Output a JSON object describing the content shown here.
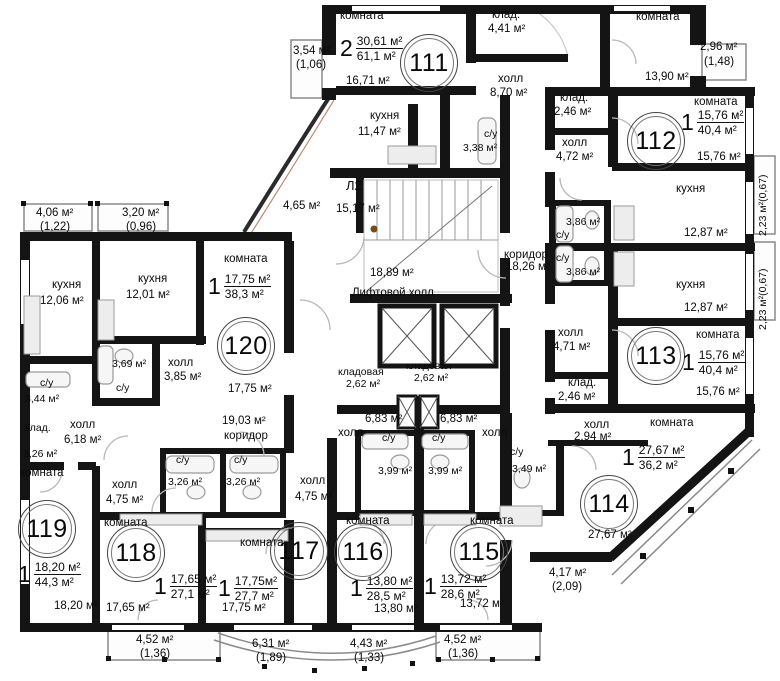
{
  "plan": {
    "common": {
      "stair": {
        "id": "Л2",
        "area": "15,17 м²"
      },
      "lift_hall": {
        "area": "18,89 м²",
        "label": "Лифтовой холл"
      },
      "vestibule_area": "4,65 м²",
      "corridor_right": {
        "label": "коридор",
        "area": "18,26 м²"
      },
      "corridor_left": {
        "area": "19,03 м²",
        "label": "коридор"
      },
      "storage_left": {
        "label": "кладовая",
        "area": "2,62 м²"
      },
      "storage_right": {
        "label": "кладовая",
        "area": "2,62 м²"
      }
    },
    "apartments": {
      "a111": {
        "number": "111",
        "rooms_count": "2",
        "area_living": "30,61 м²",
        "area_total": "61,1 м²",
        "room1_label": "комната",
        "room1_area": "16,71 м²",
        "room1_balcony": "3,54 м²",
        "room1_balcony_k": "(1,06)",
        "room2_label": "комната",
        "room2_area": "13,90 м²",
        "room2_balcony": "2,96 м²",
        "room2_balcony_k": "(1,48)",
        "storage_label": "клад.",
        "storage_area": "4,41 м²",
        "hall_label": "холл",
        "hall_area": "8,70 м²",
        "kitchen_label": "кухня",
        "kitchen_area": "11,47 м²",
        "wc_label": "с/у",
        "wc_area": "3,38 м²"
      },
      "a112": {
        "number": "112",
        "rooms_count": "1",
        "area_living": "15,76 м²",
        "area_total": "40,4 м²",
        "room_label": "комната",
        "room_area": "15,76 м²",
        "storage_label": "клад.",
        "storage_area": "2,46 м²",
        "hall_label": "холл",
        "hall_area": "4,72 м²",
        "kitchen_label": "кухня",
        "kitchen_area": "12,87 м²",
        "wc_label": "с/у",
        "wc_area": "3,86 м²",
        "balcony": "2,23 м²(0,67)"
      },
      "a113": {
        "number": "113",
        "rooms_count": "1",
        "area_living": "15,76 м²",
        "area_total": "40,4 м²",
        "room_label": "комната",
        "room_area": "15,76 м²",
        "storage_label": "клад.",
        "storage_area": "2,46 м²",
        "hall_label": "холл",
        "hall_area": "4,71 м²",
        "kitchen_label": "кухня",
        "kitchen_area": "12,87 м²",
        "wc_label": "с/у",
        "wc_area": "3,86 м²",
        "balcony": "2,23 м²(0,67)"
      },
      "a114": {
        "number": "114",
        "rooms_count": "1",
        "area_living": "27,67 м²",
        "area_total": "36,2 м²",
        "room_label": "комната",
        "room_area": "27,67 м²",
        "hall_label": "холл",
        "hall_area": "2,94 м²",
        "wc_label": "с/у",
        "wc_area": "3,49 м²",
        "balcony": "4,17 м²",
        "balcony_k": "(2,09)"
      },
      "a115": {
        "number": "115",
        "rooms_count": "1",
        "area_living": "13,72 м²",
        "area_total": "28,6 м²",
        "room_label": "комната",
        "room_area": "13,72 м²",
        "hall_label": "холл",
        "hall_area": "6,83 м²",
        "wc_label": "с/у",
        "wc_area": "3,99 м²",
        "balcony": "4,52 м²",
        "balcony_k": "(1,36)"
      },
      "a116": {
        "number": "116",
        "rooms_count": "1",
        "area_living": "13,80 м²",
        "area_total": "28,5 м²",
        "room_label": "комната",
        "room_area": "13,80 м²",
        "hall_label": "холл",
        "hall_area": "6,83 м²",
        "wc_label": "с/у",
        "wc_area": "3,99 м²",
        "balcony": "4,43 м²",
        "balcony_k": "(1,33)"
      },
      "a117": {
        "number": "117",
        "rooms_count": "1",
        "area_living": "17,75м²",
        "area_total": "27,7 м²",
        "room_label": "комната",
        "room_area": "17,75 м²",
        "hall_label": "холл",
        "hall_area": "4,75 м²",
        "wc_label": "с/у",
        "wc_area": "3,26 м²",
        "balcony": "6,31 м²",
        "balcony_k": "(1,89)"
      },
      "a118": {
        "number": "118",
        "rooms_count": "1",
        "area_living": "17,65 м²",
        "area_total": "27,1 м²",
        "room_label": "комната",
        "room_area": "17,65 м²",
        "hall_label": "холл",
        "hall_area": "4,75 м²",
        "wc_label": "с/у",
        "wc_area": "3,26 м²",
        "balcony": "4,52 м²",
        "balcony_k": "(1,36)"
      },
      "a119": {
        "number": "119",
        "rooms_count": "1",
        "area_living": "18,20 м²",
        "area_total": "44,3 м²",
        "room_label": "комната",
        "room_area": "18,20 м²",
        "kitchen_label": "кухня",
        "kitchen_area": "12,06 м²",
        "hall_label": "холл",
        "hall_area": "6,18 м²",
        "wc_label": "с/у",
        "wc_area": "3,44 м²",
        "storage_label": "клад.",
        "storage_area": "3,26 м²",
        "balcony": "4,06 м²",
        "balcony_k": "(1,22)"
      },
      "a120": {
        "number": "120",
        "rooms_count": "1",
        "area_living": "17,75 м²",
        "area_total": "38,3 м²",
        "room_label": "комната",
        "room_area": "17,75 м²",
        "kitchen_label": "кухня",
        "kitchen_area": "12,01 м²",
        "hall_label": "холл",
        "hall_area": "3,85 м²",
        "wc_label": "с/у",
        "wc_area": "3,69 м²",
        "balcony": "3,20 м²",
        "balcony_k": "(0,96)"
      }
    }
  }
}
